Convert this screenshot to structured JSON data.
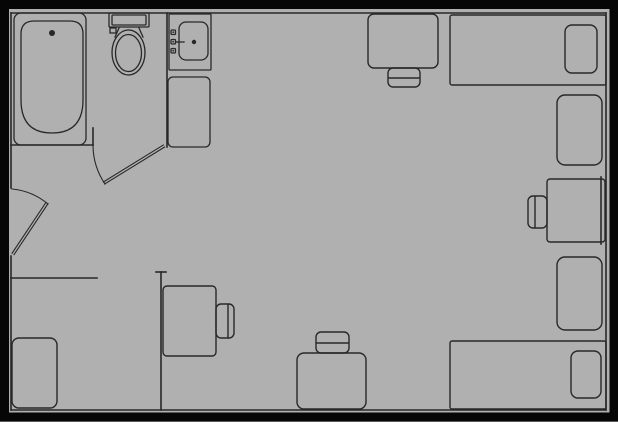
{
  "canvas": {
    "width": 618,
    "height": 422,
    "background_color": "#b0b0b0",
    "line_color": "#282828",
    "border_color": "#060606",
    "border_thickness": 9
  },
  "stroke_widths": {
    "walls": 1.6,
    "fixtures": 1.3,
    "doors": 1.1,
    "furniture": 1.4
  },
  "plan": {
    "walls": [
      {
        "name": "wall-top-inner",
        "type": "line",
        "p": [
          11,
          13,
          606,
          13
        ]
      },
      {
        "name": "wall-right-inner",
        "type": "line",
        "p": [
          606,
          13,
          606,
          410
        ]
      },
      {
        "name": "wall-bottom-inner",
        "type": "line",
        "p": [
          11,
          410,
          606,
          410
        ]
      },
      {
        "name": "wall-left-upper",
        "type": "line",
        "p": [
          11,
          13,
          11,
          188
        ]
      },
      {
        "name": "wall-left-lower",
        "type": "line",
        "p": [
          11,
          256,
          11,
          410
        ]
      },
      {
        "name": "bathroom-south-wall",
        "type": "line",
        "p": [
          11,
          145,
          93,
          145
        ]
      },
      {
        "name": "bathroom-door-jamb",
        "type": "line",
        "p": [
          93,
          128,
          93,
          145
        ]
      },
      {
        "name": "bathroom-divider-wall",
        "type": "line",
        "p": [
          167,
          13,
          167,
          147
        ]
      },
      {
        "name": "closet-partition-wall",
        "type": "line",
        "p": [
          11,
          278,
          97,
          278
        ]
      },
      {
        "name": "interior-wall",
        "type": "line",
        "p": [
          161,
          272,
          161,
          410
        ]
      },
      {
        "name": "interior-wall-cap",
        "type": "line",
        "p": [
          156,
          272,
          166,
          272
        ]
      },
      {
        "name": "desk-wall-edge-line",
        "type": "line",
        "p": [
          601,
          177,
          601,
          244
        ]
      }
    ],
    "fixtures": [
      {
        "name": "bathtub-rim",
        "type": "rect",
        "p": [
          14,
          13,
          72,
          132,
          7
        ]
      },
      {
        "name": "bathtub-basin",
        "type": "path",
        "d": "M 21 34 Q 21 21 34 21 L 70 21 Q 83 21 83 34 L 83 100 Q 83 133 52 133 Q 21 133 21 100 Z"
      },
      {
        "name": "bathtub-drain",
        "type": "dot",
        "p": [
          52,
          33,
          3
        ]
      },
      {
        "name": "toilet-tank",
        "type": "rect",
        "p": [
          109,
          13,
          40,
          14,
          1
        ]
      },
      {
        "name": "toilet-tank-inner",
        "type": "rect",
        "p": [
          112,
          15,
          34,
          10,
          1
        ]
      },
      {
        "name": "toilet-flush-handle",
        "type": "rect",
        "p": [
          110,
          28,
          6,
          5,
          0
        ]
      },
      {
        "name": "toilet-neck-left",
        "type": "line",
        "p": [
          119,
          28,
          115,
          37
        ]
      },
      {
        "name": "toilet-neck-right",
        "type": "line",
        "p": [
          139,
          28,
          143,
          37
        ]
      },
      {
        "name": "toilet-bowl-outer",
        "type": "ellipse",
        "p": [
          128.5,
          52.5,
          16.5,
          22.5
        ]
      },
      {
        "name": "toilet-bowl-inner",
        "type": "ellipse",
        "p": [
          128.5,
          53,
          13,
          18.5
        ]
      },
      {
        "name": "sink-vanity",
        "type": "rect",
        "p": [
          169,
          14,
          42,
          56,
          1
        ]
      },
      {
        "name": "sink-basin",
        "type": "rect",
        "p": [
          179,
          22,
          29,
          38,
          7
        ]
      },
      {
        "name": "sink-drain",
        "type": "dot",
        "p": [
          194,
          42,
          2.2
        ]
      },
      {
        "name": "sink-faucet-spout",
        "type": "line",
        "p": [
          176,
          42,
          184,
          42
        ]
      },
      {
        "name": "sink-knob-top",
        "type": "rect",
        "p": [
          171,
          30,
          4.5,
          4.5,
          1
        ]
      },
      {
        "name": "sink-knob-top-dot",
        "type": "dot",
        "p": [
          173.2,
          32.2,
          0.9
        ]
      },
      {
        "name": "sink-knob-middle",
        "type": "rect",
        "p": [
          171,
          39.5,
          4.5,
          4.5,
          1
        ]
      },
      {
        "name": "sink-knob-middle-dot",
        "type": "dot",
        "p": [
          173.2,
          41.7,
          0.9
        ]
      },
      {
        "name": "sink-knob-bottom",
        "type": "rect",
        "p": [
          171,
          48.5,
          4.5,
          4.5,
          1
        ]
      },
      {
        "name": "sink-knob-bottom-dot",
        "type": "dot",
        "p": [
          173.2,
          50.7,
          0.9
        ]
      },
      {
        "name": "vanity-counter",
        "type": "rect",
        "p": [
          168,
          77,
          42,
          70,
          5
        ]
      }
    ],
    "doors": [
      {
        "name": "entry-door-swing",
        "type": "path",
        "d": "M 12 189 A 66 66 0 0 1 48 204"
      },
      {
        "name": "entry-door-leaf",
        "type": "dline",
        "p": [
          13,
          254,
          47,
          203
        ]
      },
      {
        "name": "bathroom-door-swing",
        "type": "path",
        "d": "M 93 146 A 70 70 0 0 0 105 184"
      },
      {
        "name": "bathroom-door-leaf",
        "type": "dline",
        "p": [
          104,
          183,
          164,
          146
        ]
      }
    ],
    "furniture": [
      {
        "name": "desk-top-wall",
        "type": "rect",
        "p": [
          368,
          14,
          70,
          54,
          6
        ]
      },
      {
        "name": "chair-desk-top",
        "type": "rect",
        "p": [
          388,
          68,
          32,
          19,
          5
        ]
      },
      {
        "name": "chair-desk-top-line",
        "type": "line",
        "p": [
          389,
          78,
          419,
          78
        ]
      },
      {
        "name": "bed-upper",
        "type": "rect",
        "p": [
          450,
          15,
          156,
          70,
          2
        ]
      },
      {
        "name": "pillow-upper",
        "type": "rect",
        "p": [
          565,
          25,
          32,
          48,
          7
        ]
      },
      {
        "name": "dresser-upper-right",
        "type": "rect",
        "p": [
          557,
          95,
          45,
          70,
          8
        ]
      },
      {
        "name": "desk-right",
        "type": "rect",
        "p": [
          547,
          179,
          58,
          63,
          3
        ]
      },
      {
        "name": "chair-desk-right",
        "type": "rect",
        "p": [
          528,
          196,
          19,
          32,
          5
        ]
      },
      {
        "name": "chair-desk-right-line",
        "type": "line",
        "p": [
          535,
          197,
          535,
          227
        ]
      },
      {
        "name": "dresser-lower-right",
        "type": "rect",
        "p": [
          557,
          257,
          45,
          73,
          8
        ]
      },
      {
        "name": "bed-lower",
        "type": "rect",
        "p": [
          450,
          341,
          156,
          68,
          2
        ]
      },
      {
        "name": "pillow-lower",
        "type": "rect",
        "p": [
          571,
          351,
          30,
          47,
          7
        ]
      },
      {
        "name": "desk-bottom",
        "type": "rect",
        "p": [
          297,
          353,
          69,
          56,
          7
        ]
      },
      {
        "name": "chair-desk-bottom",
        "type": "rect",
        "p": [
          316,
          332,
          33,
          21,
          5
        ]
      },
      {
        "name": "chair-desk-bottom-line",
        "type": "line",
        "p": [
          317,
          343,
          348,
          343
        ]
      },
      {
        "name": "desk-left",
        "type": "rect",
        "p": [
          163,
          286,
          53,
          70,
          4
        ]
      },
      {
        "name": "chair-desk-left",
        "type": "rect",
        "p": [
          216,
          304,
          18,
          34,
          5
        ]
      },
      {
        "name": "chair-desk-left-line",
        "type": "line",
        "p": [
          228,
          305,
          228,
          337
        ]
      },
      {
        "name": "dresser-lower-left",
        "type": "rect",
        "p": [
          12,
          338,
          45,
          70,
          7
        ]
      }
    ]
  }
}
